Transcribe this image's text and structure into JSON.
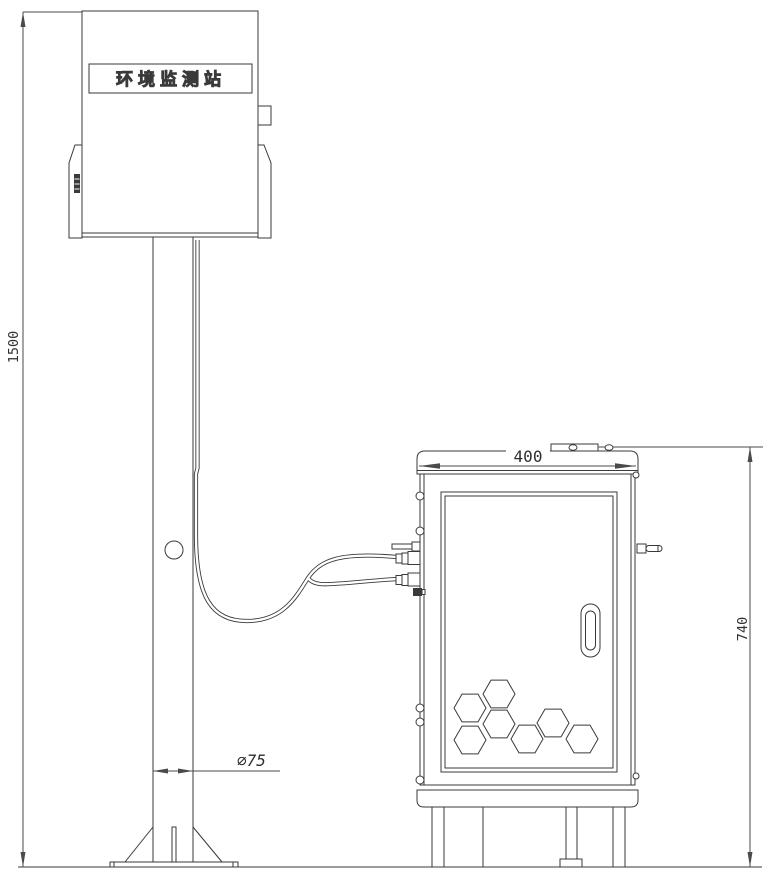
{
  "labels": {
    "station_name": "环境监测站"
  },
  "dimensions": {
    "pole_height": "1500",
    "cabinet_width": "400",
    "cabinet_height": "740",
    "pole_diameter": "∅75"
  },
  "colors": {
    "line": "#3a3a3a",
    "dim_line": "#4a4a4a",
    "background": "#ffffff"
  }
}
